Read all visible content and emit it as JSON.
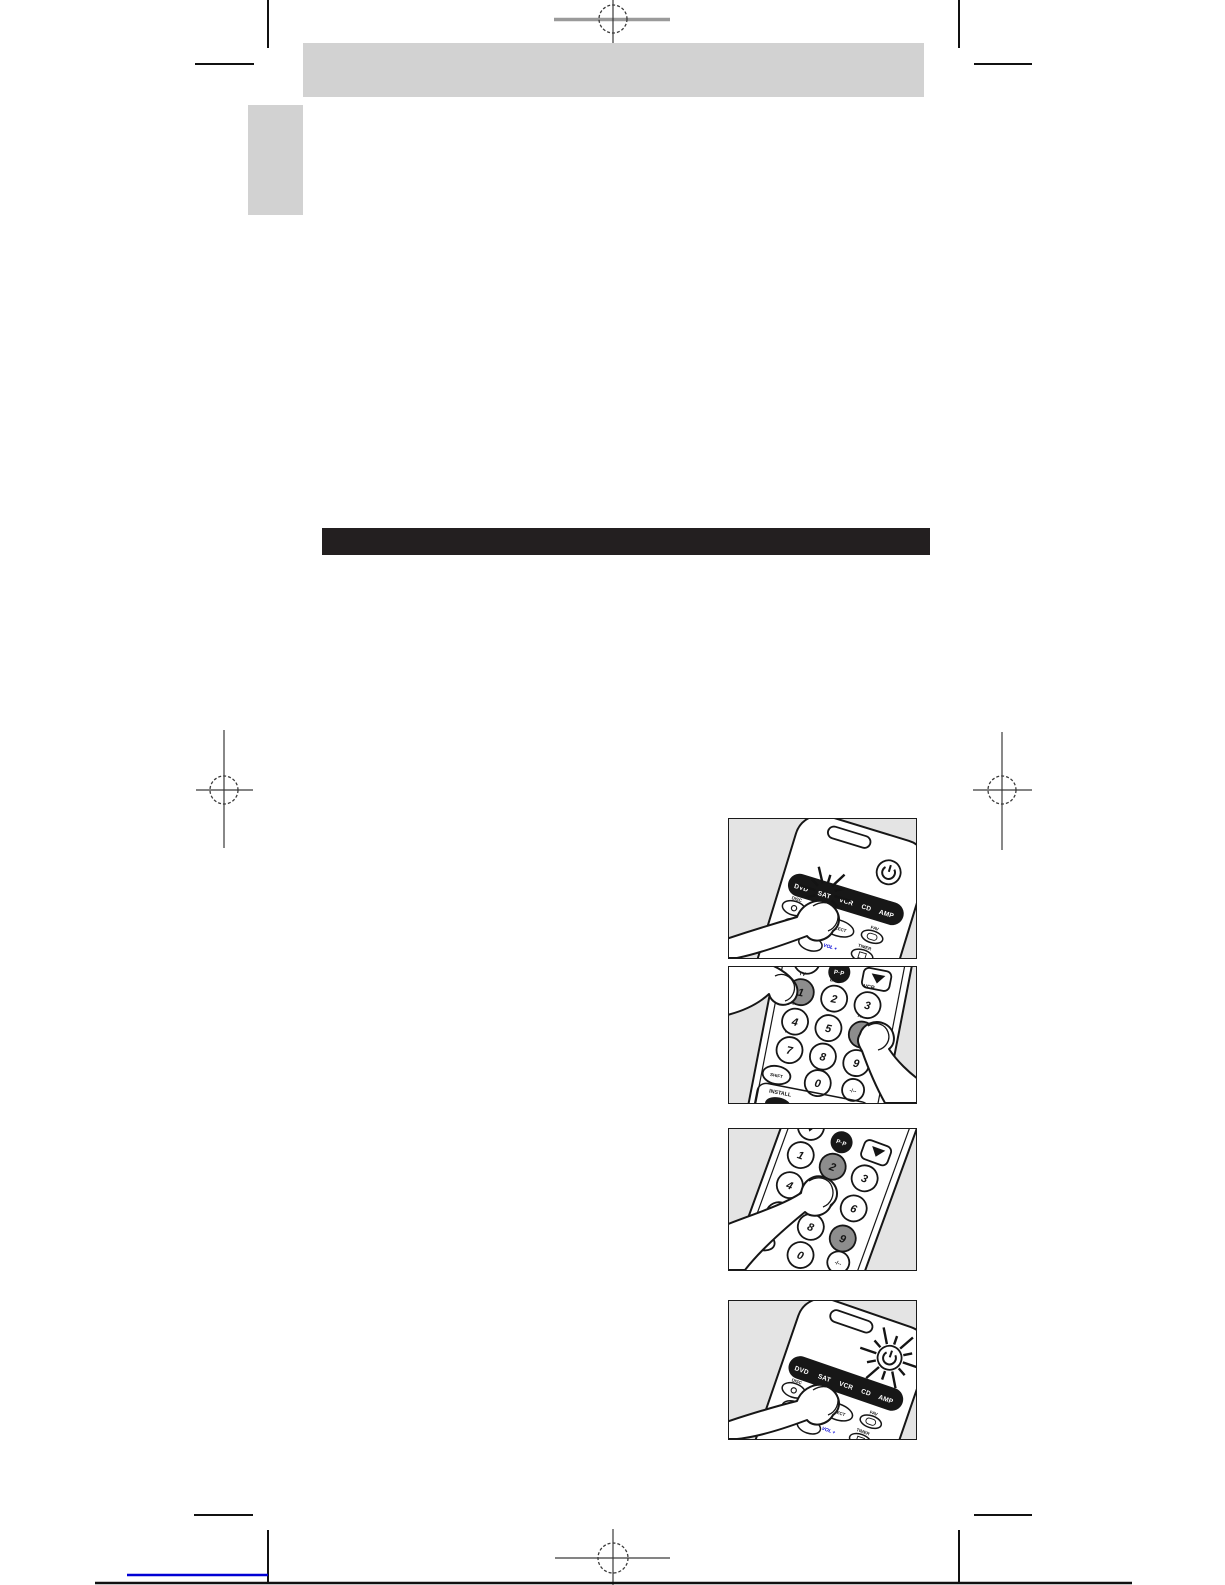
{
  "colors": {
    "accent_blue": "#0000d4",
    "placeholder_gray": "#d2d2d2",
    "figure_background": "#e4e4e4",
    "ink_black": "#231f20",
    "key_highlight_gray": "#8d8d8d"
  },
  "figures": {
    "select_source": {
      "sources": [
        "DVD",
        "SAT",
        "VCR",
        "CD",
        "AMP"
      ],
      "flashing": "SAT",
      "select_label": "SELECT",
      "disc_label": "DISC",
      "fav_label": "FAV",
      "timer_label": "TIMER",
      "vol_label": "VOL +"
    },
    "enter_code_1": {
      "digits": [
        "1",
        "2",
        "3",
        "4",
        "5",
        "6",
        "7",
        "8",
        "9",
        "0"
      ],
      "dash_key": "-/--",
      "device_labels": [
        "TV",
        "DVD",
        "VCR",
        "SAT",
        "CD",
        "AUX",
        "TAPE"
      ],
      "highlighted_keys": [
        "1",
        "6"
      ],
      "shift_label": "SHIFT",
      "install_label": "INSTALL",
      "pip_label": "P·P"
    },
    "enter_code_2": {
      "digits": [
        "1",
        "2",
        "3",
        "4",
        "5",
        "6",
        "7",
        "8",
        "9",
        "0"
      ],
      "dash_key": "-/--",
      "highlighted_keys": [
        "2",
        "9"
      ],
      "pip_label": "P·P"
    },
    "confirm": {
      "sources": [
        "DVD",
        "SAT",
        "VCR",
        "CD",
        "AMP"
      ],
      "flashing": "power",
      "select_label": "SELECT",
      "disc_label": "DISC",
      "fav_label": "FAV",
      "timer_label": "TIMER",
      "vol_label": "VOL +"
    }
  }
}
